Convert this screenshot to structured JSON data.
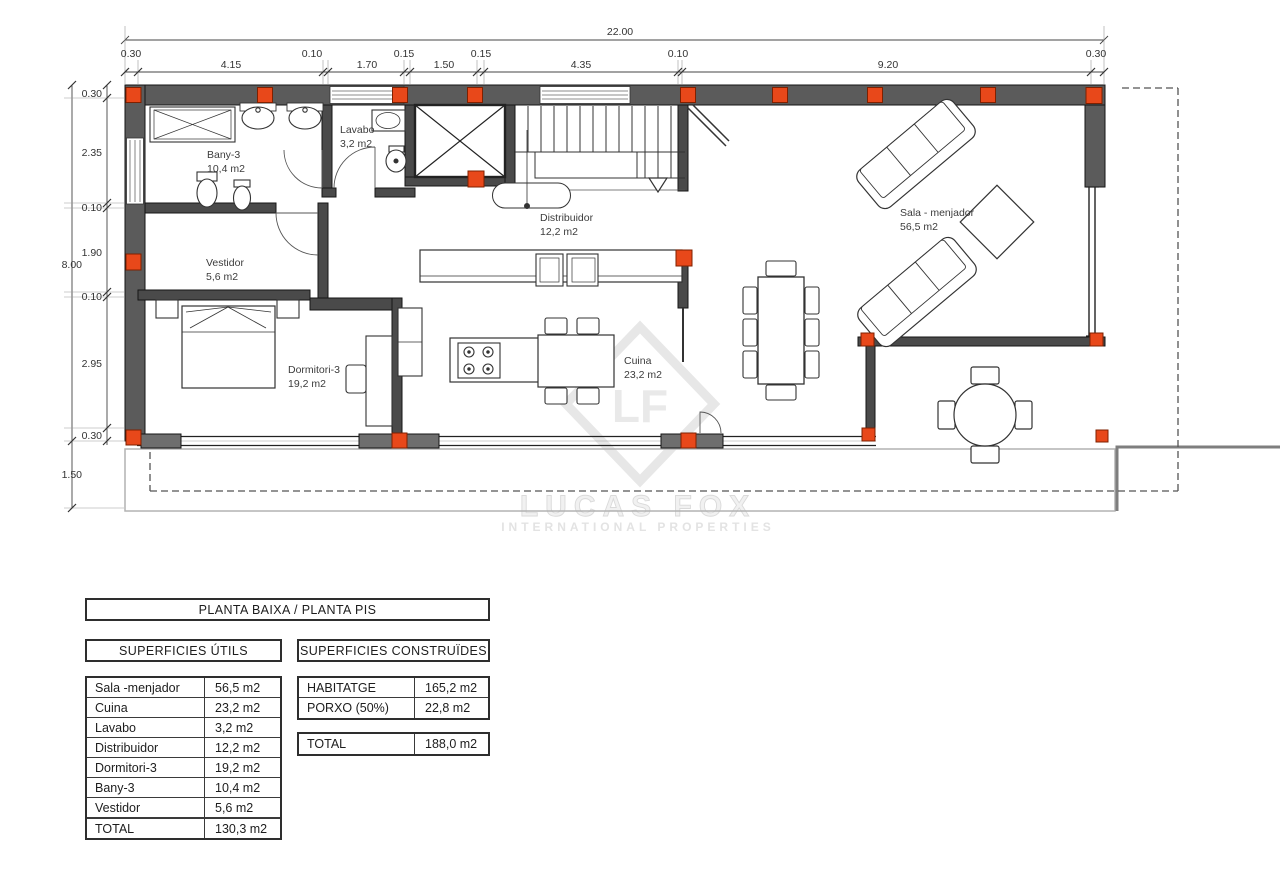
{
  "plan": {
    "dims": {
      "top_total": "22.00",
      "top": [
        "0.30",
        "4.15",
        "0.10",
        "1.70",
        "0.15",
        "1.50",
        "0.15",
        "4.35",
        "0.10",
        "9.20",
        "0.30"
      ],
      "left_total": "8.00",
      "left": [
        "0.30",
        "2.35",
        "0.10",
        "1.90",
        "0.10",
        "2.95",
        "0.30"
      ],
      "porch_depth": "1.50"
    },
    "rooms": [
      {
        "name": "Bany-3",
        "area": "10,4 m2"
      },
      {
        "name": "Lavabo",
        "area": "3,2 m2"
      },
      {
        "name": "Distribuidor",
        "area": "12,2 m2"
      },
      {
        "name": "Vestidor",
        "area": "5,6 m2"
      },
      {
        "name": "Dormitori-3",
        "area": "19,2 m2"
      },
      {
        "name": "Cuina",
        "area": "23,2 m2"
      },
      {
        "name": "Sala - menjador",
        "area": "56,5 m2"
      }
    ],
    "watermark": {
      "logo": "LF",
      "line1": "LUCAS FOX",
      "line2": "INTERNATIONAL PROPERTIES"
    },
    "colors": {
      "wall": "#5b5b5b",
      "interior_wall": "#4a4a4a",
      "column": "#e8481a",
      "watermark": "#e6e6e6"
    }
  },
  "tables": {
    "title": "PLANTA BAIXA / PLANTA PIS",
    "utils": {
      "header": "SUPERFICIES ÚTILS",
      "rows": [
        {
          "name": "Sala -menjador",
          "value": "56,5 m2"
        },
        {
          "name": "Cuina",
          "value": "23,2 m2"
        },
        {
          "name": "Lavabo",
          "value": "3,2 m2"
        },
        {
          "name": "Distribuidor",
          "value": "12,2 m2"
        },
        {
          "name": "Dormitori-3",
          "value": "19,2 m2"
        },
        {
          "name": "Bany-3",
          "value": "10,4 m2"
        },
        {
          "name": "Vestidor",
          "value": "5,6 m2"
        },
        {
          "name": "TOTAL",
          "value": "130,3 m2"
        }
      ]
    },
    "construides": {
      "header": "SUPERFICIES CONSTRUÏDES",
      "rows": [
        {
          "name": "HABITATGE",
          "value": "165,2 m2"
        },
        {
          "name": "PORXO (50%)",
          "value": "22,8 m2"
        }
      ],
      "total": {
        "name": "TOTAL",
        "value": "188,0 m2"
      }
    }
  }
}
